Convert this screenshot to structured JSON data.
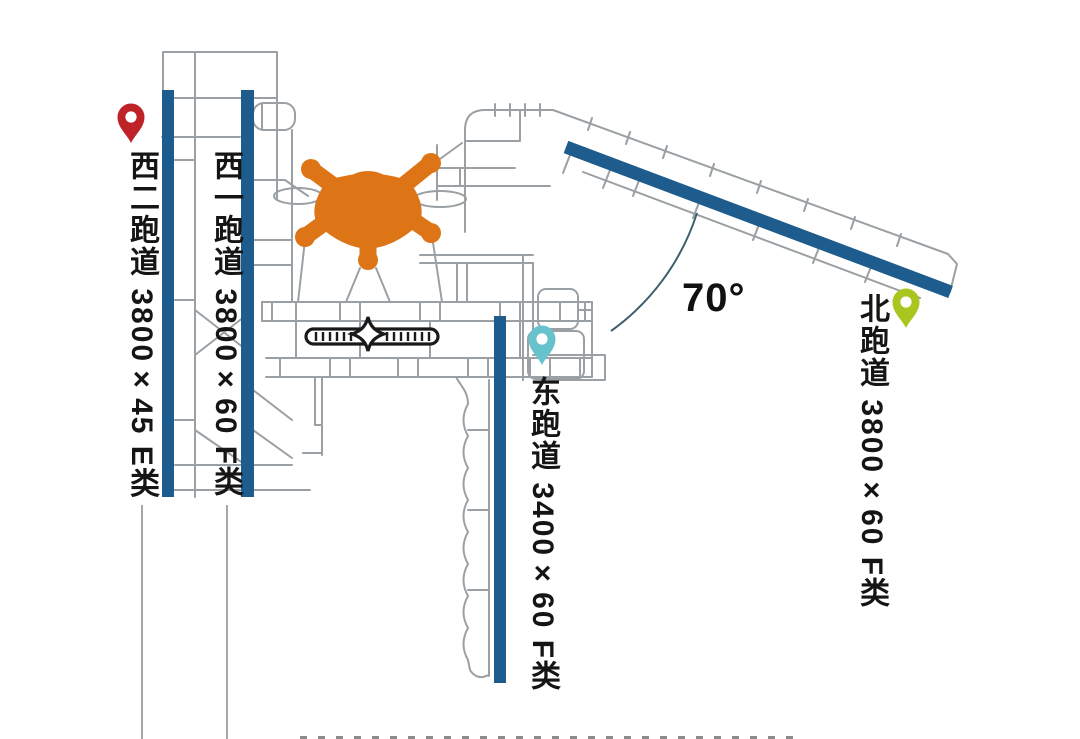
{
  "diagram": {
    "type": "airport-runway-layout",
    "angle_label": "70°",
    "runways": [
      {
        "name": "西二跑道",
        "size": "3800×45",
        "class": "E类",
        "label": "西二跑道 3800×45 E类"
      },
      {
        "name": "西一跑道",
        "size": "3800×60",
        "class": "F类",
        "label": "西一跑道 3800×60 F类"
      },
      {
        "name": "东跑道",
        "size": "3400×60",
        "class": "F类",
        "label": "东跑道 3400×60 F类"
      },
      {
        "name": "北跑道",
        "size": "3800×60",
        "class": "F类",
        "label": "北跑道 3800×60 F类"
      }
    ],
    "pins": [
      {
        "for": "西二跑道",
        "color": "#bf2328"
      },
      {
        "for": "东跑道",
        "color": "#66c2cc"
      },
      {
        "for": "北跑道",
        "color": "#a8c61d"
      }
    ],
    "colors": {
      "runway_fill": "#1d5c8c",
      "taxiway_stroke": "#9aa0a3",
      "terminal_fill": "#dd7517",
      "satellite_stroke": "#1a1a1a",
      "arc_stroke": "#3e5e6d",
      "text": "#151515"
    }
  }
}
